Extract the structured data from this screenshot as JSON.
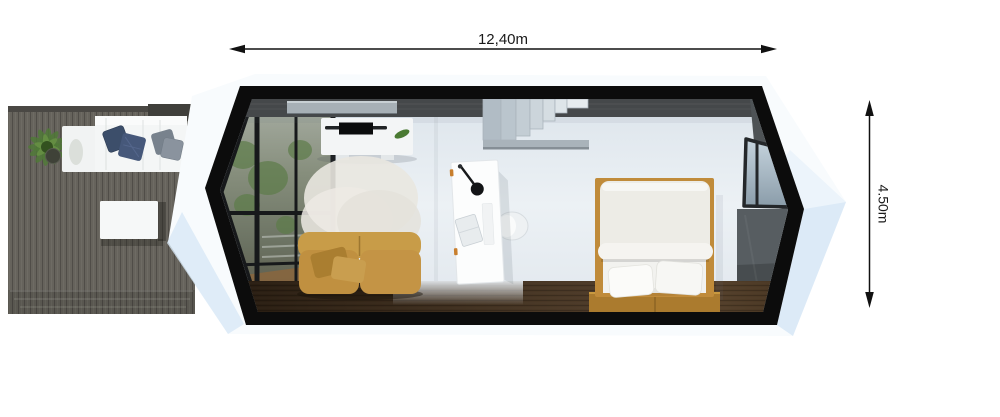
{
  "annotations": {
    "width_label": "12,40m",
    "height_label": "4.50m"
  },
  "palette": {
    "background": "#ffffff",
    "dimension_line": "#111111",
    "shell_white": "#f8fbfd",
    "shell_shadow_blue": "#d8e8f6",
    "frame_black": "#0c0c0c",
    "interior_wall": "#ecf1f5",
    "top_wall_gray": "#45484a",
    "right_wall_gray": "#575d61",
    "deck_wood_gray": "#66635c",
    "floor_wood_brown": "#4c3926",
    "sofa_mustard": "#c09040",
    "bed_frame_wood": "#c08b3a",
    "rug_white": "#e9e7e0",
    "outdoor_sofa_white": "#f4f6f6",
    "pillow_navy": "#3c4e6a",
    "pillow_gray": "#8a939e",
    "stairs_gray": "#c4ced5",
    "plant_green": "#4f7a36",
    "window_glass_green": "#76806e"
  }
}
